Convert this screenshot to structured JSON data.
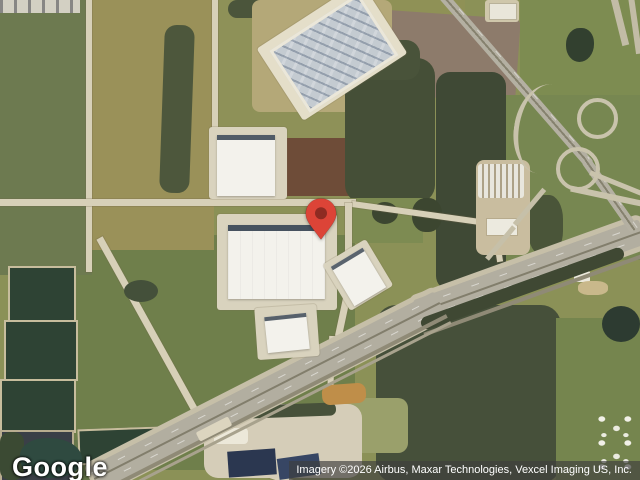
{
  "map": {
    "view_type": "satellite",
    "logo": "Google",
    "attribution": "Imagery ©2026 Airbus, Maxar Technologies, Vexcel Imaging US, Inc.",
    "marker": {
      "fill": "#DC4437",
      "dot_color": "#8E2B22"
    }
  }
}
